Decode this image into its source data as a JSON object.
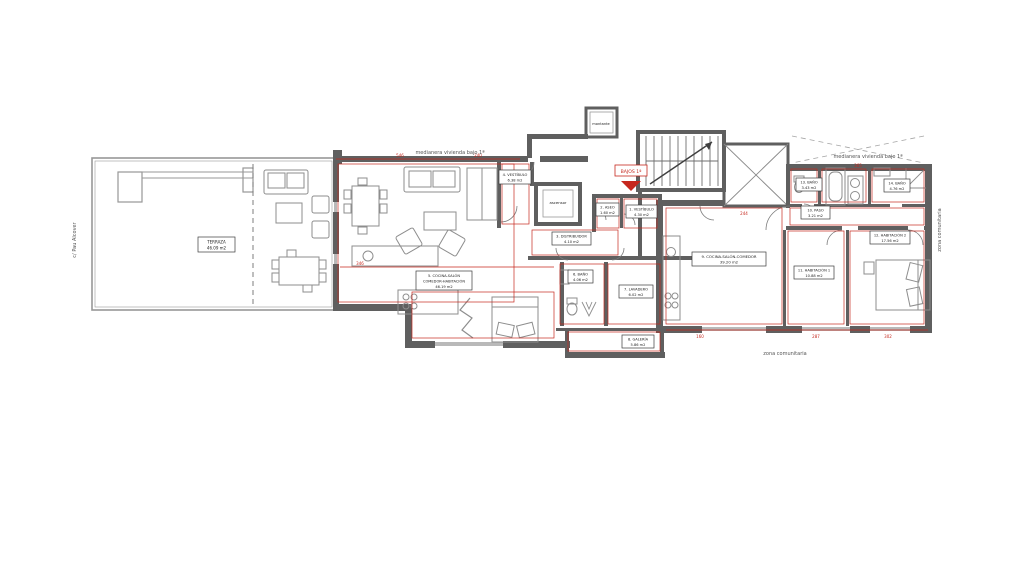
{
  "annotations": {
    "street_left": "c/ Pau Alcover",
    "party_wall_left": "medianera vivienda bajo 1ª",
    "party_wall_right": "medianera vivienda bajo 1ª",
    "communal_bottom": "zona comunitaria",
    "communal_right": "zona comunitaria",
    "entrance_tag": "BAJOS 1ª",
    "shaft_label": "montante",
    "elevator_label": "ascensor"
  },
  "rooms": {
    "terraza": {
      "name": "TERRAZA",
      "area": "46.09 m2"
    },
    "vestibulo4": {
      "name": "4. VESTÍBULO",
      "area": "6.38 m2"
    },
    "aseo2": {
      "name": "2. ASEO",
      "area": "1.60 m2"
    },
    "vestibulo1": {
      "name": "1. VESTÍBULO",
      "area": "4.30 m2"
    },
    "distribuidor3": {
      "name": "3. DISTRIBUIDOR",
      "area": "4.10 m2"
    },
    "cocina5": {
      "name": "5. COCINA-SALÓN",
      "name2": "COMEDOR-HABITACIÓN",
      "area": "46.19 m2"
    },
    "bano6": {
      "name": "6. BAÑO",
      "area": "4.06 m2"
    },
    "lavadero7": {
      "name": "7. LAVADERO",
      "area": "6.02 m2"
    },
    "galeria8": {
      "name": "8. GALERÍA",
      "area": "5.86 m2"
    },
    "cocina9": {
      "name": "9. COCINA-SALÓN-COMEDOR",
      "area": "39.20 m2"
    },
    "paso10": {
      "name": "10. PASO",
      "area": "3.21 m2"
    },
    "hab11": {
      "name": "11. HABITACIÓN 1",
      "area": "10.88 m2"
    },
    "hab12": {
      "name": "12. HABITACIÓN 2",
      "area": "17.56 m2"
    },
    "bano13": {
      "name": "13. BAÑO",
      "area": "3.43 m2"
    },
    "bano14": {
      "name": "14. BAÑO",
      "area": "4.76 m2"
    }
  },
  "dimensions": [
    "546",
    "240",
    "346",
    "160",
    "287",
    "302",
    "365",
    "244"
  ],
  "colors": {
    "wall_dark": "#5f5f5f",
    "wall_light": "#979797",
    "furniture": "#8d8d8d",
    "dimension_red": "#c6281e",
    "label_border": "#3c3c3c"
  }
}
